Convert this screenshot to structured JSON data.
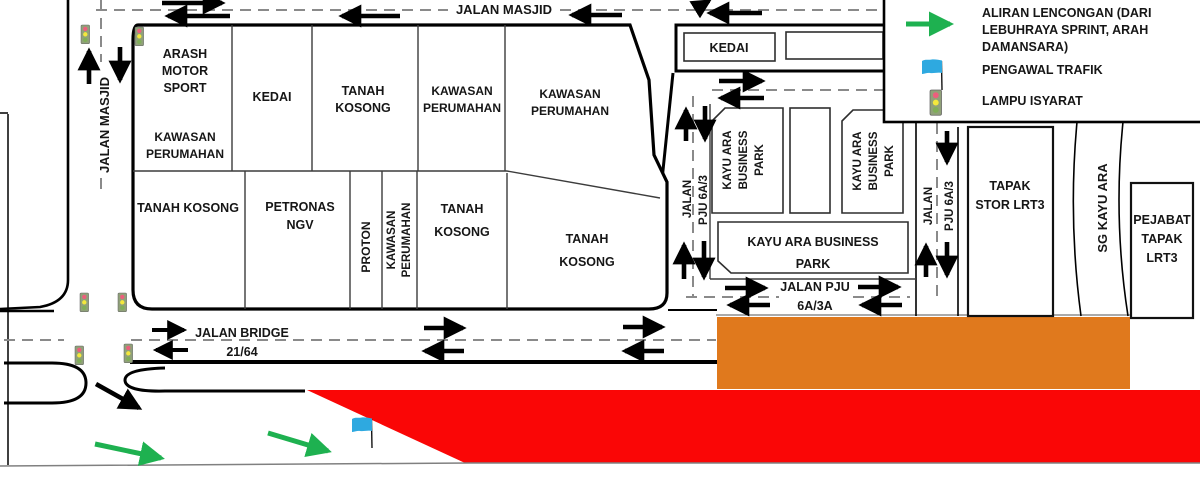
{
  "colors": {
    "orange_zone": "#E0791D",
    "red_zone": "#FA0606",
    "green": "#1EB150",
    "flag_blue": "#2EA9E0"
  },
  "roads": {
    "jalan_masjid_top": "JALAN MASJID",
    "jalan_masjid_left": "JALAN MASJID",
    "jalan_bridge": {
      "name": "JALAN BRIDGE",
      "code": "21/64"
    },
    "jalan_pju_left": {
      "line1": "JALAN",
      "line2": "PJU 6A/3"
    },
    "jalan_pju_right": {
      "line1": "JALAN",
      "line2": "PJU 6A/3"
    },
    "jalan_pju_bottom": {
      "line1": "JALAN PJU",
      "line2": "6A/3A"
    }
  },
  "parcels": {
    "arash": {
      "lines": [
        "ARASH",
        "MOTOR",
        "SPORT"
      ]
    },
    "kawasan_perumahan_a": {
      "lines": [
        "KAWASAN",
        "PERUMAHAN"
      ]
    },
    "kedai_left": {
      "lines": [
        "KEDAI"
      ]
    },
    "tanah_kosong_a": {
      "lines": [
        "TANAH",
        "KOSONG"
      ]
    },
    "kawasan_perumahan_b": {
      "lines": [
        "KAWASAN",
        "PERUMAHAN"
      ]
    },
    "kawasan_perumahan_c": {
      "lines": [
        "KAWASAN",
        "PERUMAHAN"
      ]
    },
    "tanah_kosong_b": {
      "lines": [
        "TANAH KOSONG"
      ]
    },
    "petronas_ngv": {
      "lines": [
        "PETRONAS",
        "NGV"
      ]
    },
    "proton": {
      "lines": [
        "PROTON"
      ]
    },
    "kawasan_perumahan_d": {
      "lines": [
        "KAWASAN",
        "PERUMAHAN"
      ]
    },
    "tanah_kosong_c": {
      "lines": [
        "TANAH",
        "KOSONG"
      ]
    },
    "tanah_kosong_d": {
      "lines": [
        "TANAH",
        "KOSONG"
      ]
    },
    "kedai_right": {
      "lines": [
        "KEDAI"
      ]
    },
    "kayu_ara_1": {
      "lines": [
        "KAYU ARA",
        "BUSINESS",
        "PARK"
      ]
    },
    "kayu_ara_2": {
      "lines": [
        "KAYU ARA",
        "BUSINESS",
        "PARK"
      ]
    },
    "kayu_ara_main": {
      "lines": [
        "KAYU ARA BUSINESS",
        "PARK"
      ]
    },
    "tapak_stor": {
      "lines": [
        "TAPAK",
        "STOR LRT3"
      ]
    },
    "sg_kayu_ara": {
      "lines": [
        "SG KAYU ARA"
      ]
    },
    "pejabat": {
      "lines": [
        "PEJABAT",
        "TAPAK",
        "LRT3"
      ]
    }
  },
  "legend": {
    "aliran": {
      "lines": [
        "ALIRAN LENCONGAN (DARI",
        "LEBUHRAYA SPRINT, ARAH",
        "DAMANSARA)"
      ]
    },
    "pengawal": "PENGAWAL TRAFIK",
    "lampu": "LAMPU ISYARAT"
  }
}
